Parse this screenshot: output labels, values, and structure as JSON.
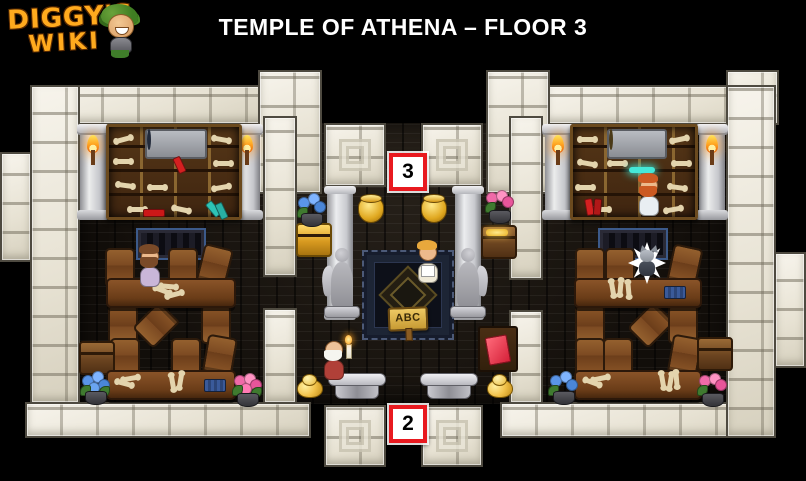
{
  "header": {
    "logo_line1": "DIGGY'S",
    "logo_line2": "WIKI",
    "title": "TEMPLE OF ATHENA – FLOOR 3"
  },
  "markers": {
    "top": {
      "label": "3",
      "meaning": "entrance to floor 3"
    },
    "bottom": {
      "label": "2",
      "meaning": "entrance to floor 2"
    }
  },
  "signs": {
    "rug_sign": "ABC"
  },
  "rooms": {
    "left_study": {
      "items": [
        "bookshelf with bones, scrolls and books",
        "blue orb relic on plaque",
        "two torch columns",
        "greek-key rug",
        "philosopher npc",
        "nine chairs",
        "two study tables with bones",
        "blue book",
        "wooden chest",
        "blue flower pot",
        "pink flower pot"
      ]
    },
    "central_hall": {
      "items": [
        "two marble columns",
        "two angel statues",
        "greek-key carpet",
        "ABC wooden sign",
        "student npc holding paper",
        "elder npc with candle",
        "two golden cauldrons",
        "golden chest",
        "wooden chest with gold",
        "red letter on desk",
        "two gold piles",
        "two marble benches",
        "blue flower pot",
        "pink flower pot"
      ]
    },
    "right_study": {
      "items": [
        "bookshelf with bones, scrolls and books",
        "globe relic on plaque",
        "glowing teal relic",
        "two torch columns",
        "greek-key rug",
        "red-bearded scholar npc",
        "wolf spirit in white burst",
        "nine chairs",
        "two study tables with bones",
        "blue book",
        "wooden chest",
        "blue flower pot",
        "pink flower pot"
      ]
    }
  },
  "colors": {
    "accent_red": "#e8191f",
    "marble": "#ece8da",
    "floor_dark": "#14100c",
    "wood": "#7b4a24",
    "gold": "#f0c040",
    "flame": "#ff9d1f",
    "statue_gray": "#a8a8ae",
    "logo_orange": "#ffaa1e",
    "title_white": "#ffffff"
  }
}
